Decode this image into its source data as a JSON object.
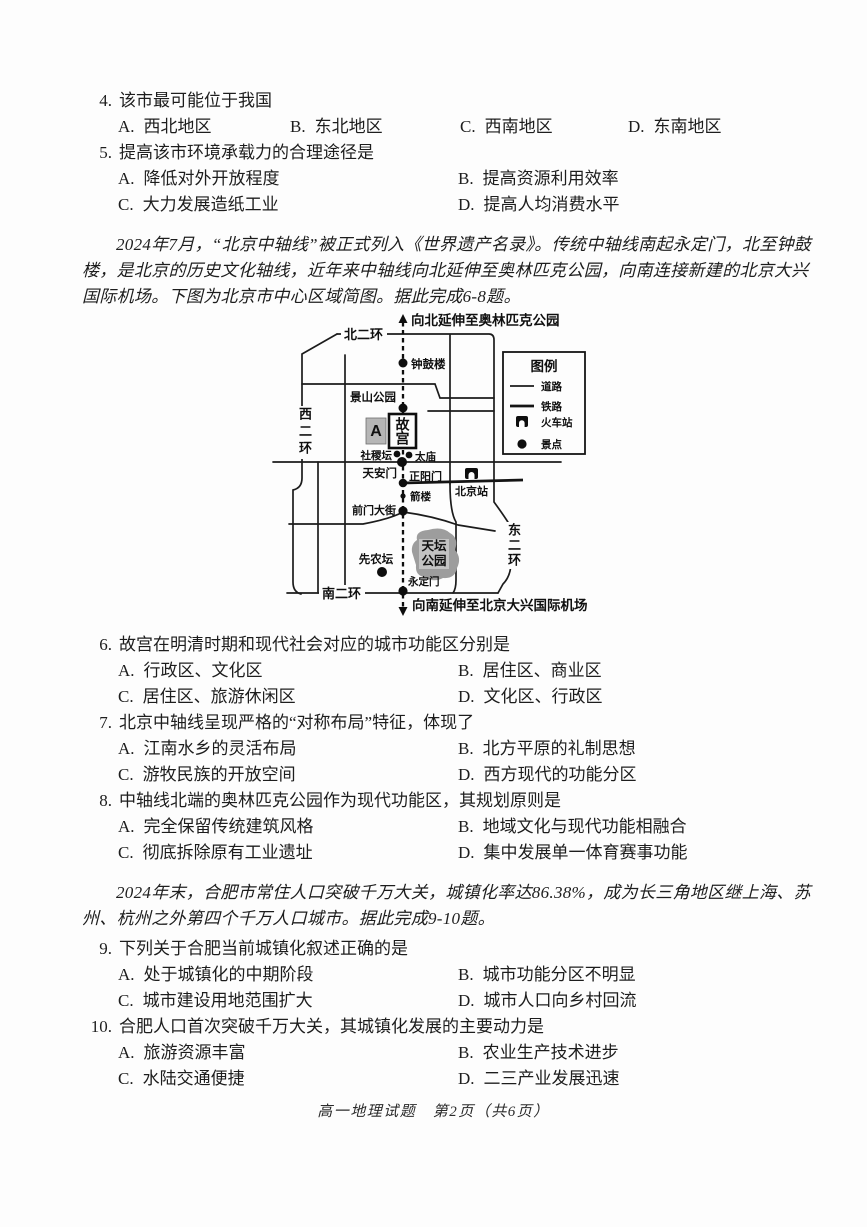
{
  "page": {
    "footer": "高一地理试题　第2页（共6页）"
  },
  "questions": [
    {
      "number": "4.",
      "stem": "该市最可能位于我国",
      "options": [
        {
          "label": "A.",
          "text": "西北地区"
        },
        {
          "label": "B.",
          "text": "东北地区"
        },
        {
          "label": "C.",
          "text": "西南地区"
        },
        {
          "label": "D.",
          "text": "东南地区"
        }
      ]
    },
    {
      "number": "5.",
      "stem": "提高该市环境承载力的合理途径是",
      "options": [
        {
          "label": "A.",
          "text": "降低对外开放程度"
        },
        {
          "label": "B.",
          "text": "提高资源利用效率"
        },
        {
          "label": "C.",
          "text": "大力发展造纸工业"
        },
        {
          "label": "D.",
          "text": "提高人均消费水平"
        }
      ]
    },
    {
      "number": "6.",
      "stem": "故宫在明清时期和现代社会对应的城市功能区分别是",
      "options": [
        {
          "label": "A.",
          "text": "行政区、文化区"
        },
        {
          "label": "B.",
          "text": "居住区、商业区"
        },
        {
          "label": "C.",
          "text": "居住区、旅游休闲区"
        },
        {
          "label": "D.",
          "text": "文化区、行政区"
        }
      ]
    },
    {
      "number": "7.",
      "stem": "北京中轴线呈现严格的“对称布局”特征，体现了",
      "options": [
        {
          "label": "A.",
          "text": "江南水乡的灵活布局"
        },
        {
          "label": "B.",
          "text": "北方平原的礼制思想"
        },
        {
          "label": "C.",
          "text": "游牧民族的开放空间"
        },
        {
          "label": "D.",
          "text": "西方现代的功能分区"
        }
      ]
    },
    {
      "number": "8.",
      "stem": "中轴线北端的奥林匹克公园作为现代功能区，其规划原则是",
      "options": [
        {
          "label": "A.",
          "text": "完全保留传统建筑风格"
        },
        {
          "label": "B.",
          "text": "地域文化与现代功能相融合"
        },
        {
          "label": "C.",
          "text": "彻底拆除原有工业遗址"
        },
        {
          "label": "D.",
          "text": "集中发展单一体育赛事功能"
        }
      ]
    },
    {
      "number": "9.",
      "stem": "下列关于合肥当前城镇化叙述正确的是",
      "options": [
        {
          "label": "A.",
          "text": "处于城镇化的中期阶段"
        },
        {
          "label": "B.",
          "text": "城市功能分区不明显"
        },
        {
          "label": "C.",
          "text": "城市建设用地范围扩大"
        },
        {
          "label": "D.",
          "text": "城市人口向乡村回流"
        }
      ]
    },
    {
      "number": "10.",
      "stem": "合肥人口首次突破千万大关，其城镇化发展的主要动力是",
      "options": [
        {
          "label": "A.",
          "text": "旅游资源丰富"
        },
        {
          "label": "B.",
          "text": "农业生产技术进步"
        },
        {
          "label": "C.",
          "text": "水陆交通便捷"
        },
        {
          "label": "D.",
          "text": "二三产业发展迅速"
        }
      ]
    }
  ],
  "passages": [
    {
      "text": "2024年7月，“北京中轴线”被正式列入《世界遗产名录》。传统中轴线南起永定门，北至钟鼓楼，是北京的历史文化轴线，近年来中轴线向北延伸至奥林匹克公园，向南连接新建的北京大兴国际机场。下图为北京市中心区域简图。据此完成6-8题。"
    },
    {
      "text": "2024年末，合肥市常住人口突破千万大关，城镇化率达86.38%，成为长三角地区继上海、苏州、杭州之外第四个千万人口城市。据此完成9-10题。"
    }
  ],
  "map": {
    "extend_north": "向北延伸至奥林匹克公园",
    "extend_south": "向南延伸至北京大兴国际机场",
    "ring_north": "北二环",
    "ring_west": "西二环",
    "ring_east": "东二环",
    "ring_south": "南二环",
    "bell_drum_tower": "钟鼓楼",
    "jingshan_park": "景山公园",
    "area_a": "A",
    "forbidden_city": "故宫",
    "shejitan": "社稷坛",
    "taimiao": "太庙",
    "tiananmen": "天安门",
    "zhengyangmen": "正阳门",
    "beijing_station": "北京站",
    "jianlou": "箭楼",
    "qianmen_street": "前门大街",
    "tiantan_line1": "天坛",
    "tiantan_line2": "公园",
    "xiannongtan": "先农坛",
    "yongdingmen": "永定门",
    "legend": {
      "title": "图例",
      "items": [
        {
          "symbol": "road-line",
          "label": "道路"
        },
        {
          "symbol": "railway-line",
          "label": "铁路"
        },
        {
          "symbol": "train-station-icon",
          "label": "火车站"
        },
        {
          "symbol": "scenic-spot-dot",
          "label": "景点"
        }
      ]
    }
  }
}
